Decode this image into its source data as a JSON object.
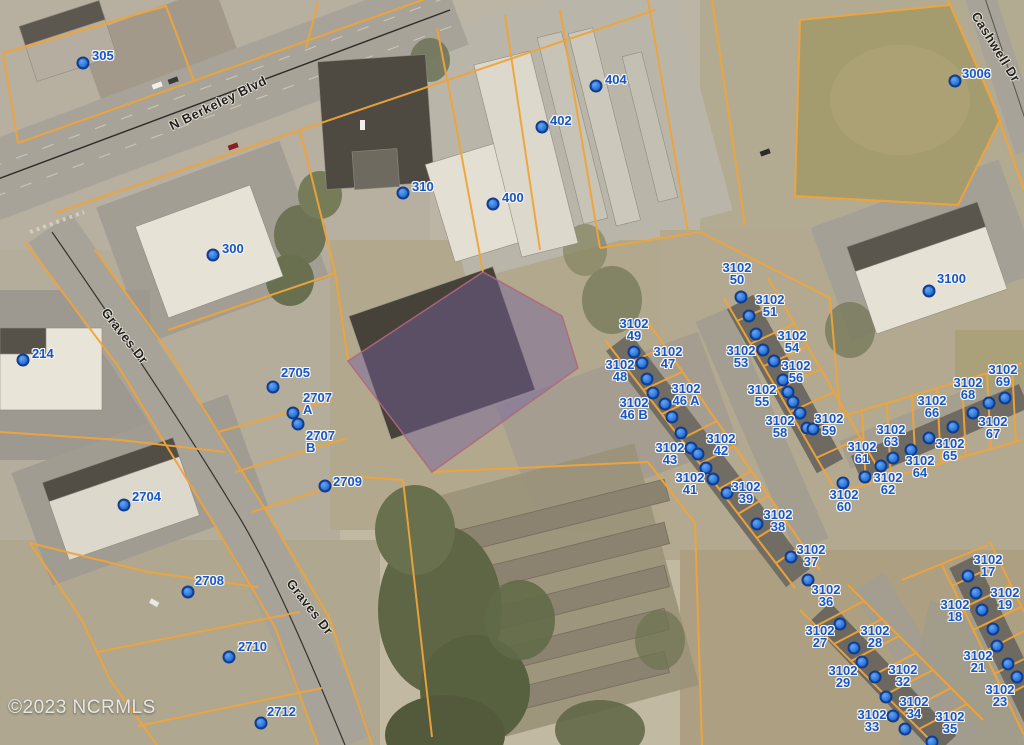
{
  "map": {
    "copyright": "©2023 NCRMLS",
    "streets": [
      {
        "name": "N Berkeley Blvd",
        "x": 218,
        "y": 103,
        "rot": -26
      },
      {
        "name": "Graves Dr",
        "x": 125,
        "y": 336,
        "rot": 52
      },
      {
        "name": "Graves Dr",
        "x": 310,
        "y": 607,
        "rot": 52
      },
      {
        "name": "Cashwell Dr",
        "x": 996,
        "y": 47,
        "rot": 58
      }
    ],
    "parcel_labels": [
      {
        "lines": [
          "305"
        ],
        "x": 92,
        "y": 50,
        "align": "left"
      },
      {
        "lines": [
          "310"
        ],
        "x": 412,
        "y": 181,
        "align": "left"
      },
      {
        "lines": [
          "402"
        ],
        "x": 550,
        "y": 115,
        "align": "left"
      },
      {
        "lines": [
          "404"
        ],
        "x": 605,
        "y": 74,
        "align": "left"
      },
      {
        "lines": [
          "400"
        ],
        "x": 502,
        "y": 192,
        "align": "left"
      },
      {
        "lines": [
          "3006"
        ],
        "x": 962,
        "y": 68,
        "align": "left"
      },
      {
        "lines": [
          "300"
        ],
        "x": 222,
        "y": 243,
        "align": "left"
      },
      {
        "lines": [
          "214"
        ],
        "x": 32,
        "y": 348,
        "align": "left"
      },
      {
        "lines": [
          "2705"
        ],
        "x": 281,
        "y": 367,
        "align": "left"
      },
      {
        "lines": [
          "2707",
          "A"
        ],
        "x": 303,
        "y": 392,
        "align": "left"
      },
      {
        "lines": [
          "2707",
          "B"
        ],
        "x": 306,
        "y": 430,
        "align": "left"
      },
      {
        "lines": [
          "2709"
        ],
        "x": 333,
        "y": 476,
        "align": "left"
      },
      {
        "lines": [
          "2704"
        ],
        "x": 132,
        "y": 491,
        "align": "left"
      },
      {
        "lines": [
          "2708"
        ],
        "x": 195,
        "y": 575,
        "align": "left"
      },
      {
        "lines": [
          "2710"
        ],
        "x": 238,
        "y": 641,
        "align": "left"
      },
      {
        "lines": [
          "2712"
        ],
        "x": 267,
        "y": 706,
        "align": "left"
      },
      {
        "lines": [
          "3100"
        ],
        "x": 937,
        "y": 273,
        "align": "left"
      },
      {
        "lines": [
          "3102",
          "50"
        ],
        "x": 737,
        "y": 262,
        "align": "center"
      },
      {
        "lines": [
          "3102",
          "51"
        ],
        "x": 770,
        "y": 294,
        "align": "center"
      },
      {
        "lines": [
          "3102",
          "49"
        ],
        "x": 634,
        "y": 318,
        "align": "center"
      },
      {
        "lines": [
          "3102",
          "47"
        ],
        "x": 668,
        "y": 346,
        "align": "center"
      },
      {
        "lines": [
          "3102",
          "48"
        ],
        "x": 620,
        "y": 359,
        "align": "center"
      },
      {
        "lines": [
          "3102",
          "53"
        ],
        "x": 741,
        "y": 345,
        "align": "center"
      },
      {
        "lines": [
          "3102",
          "54"
        ],
        "x": 792,
        "y": 330,
        "align": "center"
      },
      {
        "lines": [
          "3102",
          "56"
        ],
        "x": 796,
        "y": 360,
        "align": "center"
      },
      {
        "lines": [
          "3102",
          "55"
        ],
        "x": 762,
        "y": 384,
        "align": "center"
      },
      {
        "lines": [
          "3102",
          "46 A"
        ],
        "x": 686,
        "y": 383,
        "align": "center"
      },
      {
        "lines": [
          "3102",
          "46 B"
        ],
        "x": 634,
        "y": 397,
        "align": "center"
      },
      {
        "lines": [
          "3102",
          "58"
        ],
        "x": 780,
        "y": 415,
        "align": "center"
      },
      {
        "lines": [
          "3102",
          "59"
        ],
        "x": 829,
        "y": 413,
        "align": "center"
      },
      {
        "lines": [
          "3102",
          "42"
        ],
        "x": 721,
        "y": 433,
        "align": "center"
      },
      {
        "lines": [
          "3102",
          "43"
        ],
        "x": 670,
        "y": 442,
        "align": "center"
      },
      {
        "lines": [
          "3102",
          "41"
        ],
        "x": 690,
        "y": 472,
        "align": "center"
      },
      {
        "lines": [
          "3102",
          "39"
        ],
        "x": 746,
        "y": 481,
        "align": "center"
      },
      {
        "lines": [
          "3102",
          "38"
        ],
        "x": 778,
        "y": 509,
        "align": "center"
      },
      {
        "lines": [
          "3102",
          "37"
        ],
        "x": 811,
        "y": 544,
        "align": "center"
      },
      {
        "lines": [
          "3102",
          "36"
        ],
        "x": 826,
        "y": 584,
        "align": "center"
      },
      {
        "lines": [
          "3102",
          "60"
        ],
        "x": 844,
        "y": 489,
        "align": "center"
      },
      {
        "lines": [
          "3102",
          "61"
        ],
        "x": 862,
        "y": 441,
        "align": "center"
      },
      {
        "lines": [
          "3102",
          "62"
        ],
        "x": 888,
        "y": 472,
        "align": "center"
      },
      {
        "lines": [
          "3102",
          "63"
        ],
        "x": 891,
        "y": 424,
        "align": "center"
      },
      {
        "lines": [
          "3102",
          "64"
        ],
        "x": 920,
        "y": 455,
        "align": "center"
      },
      {
        "lines": [
          "3102",
          "65"
        ],
        "x": 950,
        "y": 438,
        "align": "center"
      },
      {
        "lines": [
          "3102",
          "66"
        ],
        "x": 932,
        "y": 395,
        "align": "center"
      },
      {
        "lines": [
          "3102",
          "67"
        ],
        "x": 993,
        "y": 416,
        "align": "center"
      },
      {
        "lines": [
          "3102",
          "68"
        ],
        "x": 968,
        "y": 377,
        "align": "center"
      },
      {
        "lines": [
          "3102",
          "69"
        ],
        "x": 1003,
        "y": 364,
        "align": "center"
      },
      {
        "lines": [
          "3102",
          "17"
        ],
        "x": 988,
        "y": 554,
        "align": "center"
      },
      {
        "lines": [
          "3102",
          "18"
        ],
        "x": 955,
        "y": 599,
        "align": "center"
      },
      {
        "lines": [
          "3102",
          "19"
        ],
        "x": 1005,
        "y": 587,
        "align": "center"
      },
      {
        "lines": [
          "3102",
          "21"
        ],
        "x": 978,
        "y": 650,
        "align": "center"
      },
      {
        "lines": [
          "3102",
          "23"
        ],
        "x": 1000,
        "y": 684,
        "align": "center"
      },
      {
        "lines": [
          "3102",
          "27"
        ],
        "x": 820,
        "y": 625,
        "align": "center"
      },
      {
        "lines": [
          "3102",
          "28"
        ],
        "x": 875,
        "y": 625,
        "align": "center"
      },
      {
        "lines": [
          "3102",
          "29"
        ],
        "x": 843,
        "y": 665,
        "align": "center"
      },
      {
        "lines": [
          "3102",
          "32"
        ],
        "x": 903,
        "y": 664,
        "align": "center"
      },
      {
        "lines": [
          "3102",
          "33"
        ],
        "x": 872,
        "y": 709,
        "align": "center"
      },
      {
        "lines": [
          "3102",
          "34"
        ],
        "x": 914,
        "y": 696,
        "align": "center"
      },
      {
        "lines": [
          "3102",
          "35"
        ],
        "x": 950,
        "y": 711,
        "align": "center"
      }
    ],
    "dots": [
      [
        83,
        63
      ],
      [
        403,
        193
      ],
      [
        542,
        127
      ],
      [
        596,
        86
      ],
      [
        493,
        204
      ],
      [
        955,
        81
      ],
      [
        213,
        255
      ],
      [
        23,
        360
      ],
      [
        273,
        387
      ],
      [
        293,
        413
      ],
      [
        298,
        424
      ],
      [
        325,
        486
      ],
      [
        124,
        505
      ],
      [
        188,
        592
      ],
      [
        229,
        657
      ],
      [
        261,
        723
      ],
      [
        929,
        291
      ],
      [
        634,
        352
      ],
      [
        642,
        363
      ],
      [
        647,
        379
      ],
      [
        653,
        393
      ],
      [
        665,
        404
      ],
      [
        672,
        417
      ],
      [
        681,
        433
      ],
      [
        691,
        448
      ],
      [
        698,
        454
      ],
      [
        706,
        468
      ],
      [
        713,
        479
      ],
      [
        727,
        493
      ],
      [
        757,
        524
      ],
      [
        791,
        557
      ],
      [
        808,
        580
      ],
      [
        741,
        297
      ],
      [
        749,
        316
      ],
      [
        756,
        334
      ],
      [
        763,
        350
      ],
      [
        774,
        361
      ],
      [
        783,
        380
      ],
      [
        788,
        392
      ],
      [
        793,
        402
      ],
      [
        800,
        413
      ],
      [
        807,
        428
      ],
      [
        813,
        429
      ],
      [
        1005,
        398
      ],
      [
        989,
        403
      ],
      [
        973,
        413
      ],
      [
        953,
        427
      ],
      [
        929,
        438
      ],
      [
        911,
        450
      ],
      [
        893,
        458
      ],
      [
        881,
        466
      ],
      [
        865,
        477
      ],
      [
        843,
        483
      ],
      [
        968,
        576
      ],
      [
        976,
        593
      ],
      [
        982,
        610
      ],
      [
        993,
        629
      ],
      [
        997,
        646
      ],
      [
        1008,
        664
      ],
      [
        1017,
        677
      ],
      [
        840,
        624
      ],
      [
        854,
        648
      ],
      [
        862,
        662
      ],
      [
        875,
        677
      ],
      [
        886,
        697
      ],
      [
        893,
        716
      ],
      [
        905,
        729
      ],
      [
        932,
        742
      ]
    ],
    "highlight_parcel": {
      "points": "483,272 562,316 578,368 432,472 348,361"
    },
    "colors": {
      "parcel_line": "#f0a43a",
      "label_blue": "#1556c8",
      "dot_fill": "#2f7ce0",
      "dot_border": "#123c8c",
      "highlight_fill": "rgba(118,96,158,0.45)",
      "highlight_stroke": "rgba(176,104,122,0.9)",
      "street_text": "#1f1f1f",
      "copyright_text": "#e6e6e4"
    }
  }
}
